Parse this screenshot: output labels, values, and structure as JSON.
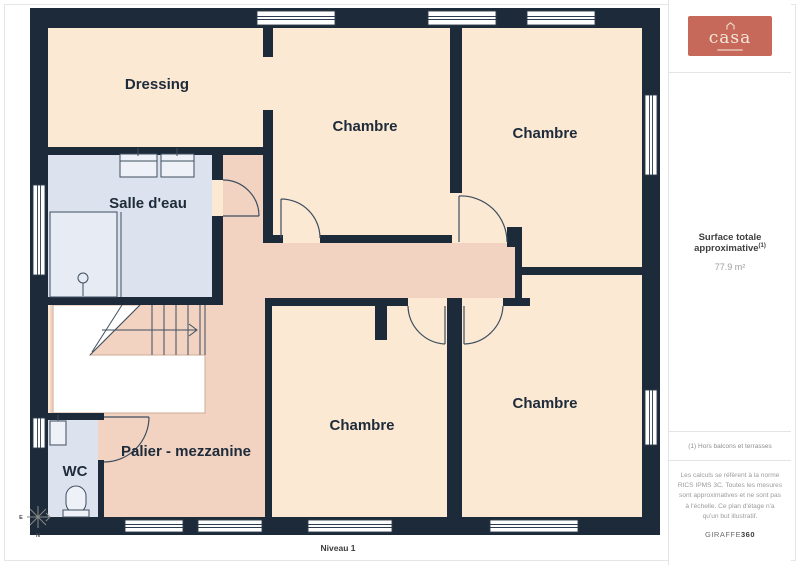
{
  "plan": {
    "rooms": [
      {
        "name": "dressing",
        "label": "Dressing"
      },
      {
        "name": "chambre-top-middle",
        "label": "Chambre"
      },
      {
        "name": "chambre-top-right",
        "label": "Chambre"
      },
      {
        "name": "salle-deau",
        "label": "Salle d'eau"
      },
      {
        "name": "chambre-bottom-right",
        "label": "Chambre"
      },
      {
        "name": "chambre-bottom-middle",
        "label": "Chambre"
      },
      {
        "name": "palier",
        "label": "Palier - mezzanine"
      },
      {
        "name": "wc",
        "label": "WC"
      }
    ],
    "level_label": "Niveau 1",
    "compass": {
      "east": "E",
      "north": "N"
    },
    "colors": {
      "wall": "#1d2a39",
      "room_fill": "#fbe9d3",
      "hall_fill": "#f2d3c1",
      "wet_room_fill": "#dde3ee",
      "fixture_fill": "#eef1f7",
      "logo_bg": "#c7695a"
    }
  },
  "sidebar": {
    "logo": {
      "brand": "casa"
    },
    "surface": {
      "title": "Surface totale approximative",
      "note_ref": "(1)",
      "value": "77.9 m²"
    },
    "footnote": "(1) Hors balcons et terrasses",
    "disclaimer": "Les calculs se réfèrent à la norme RICS IPMS 3C. Toutes les mesures sont approximatives et ne sont pas à l'échelle. Ce plan d'étage n'a qu'un but illustratif.",
    "watermark": {
      "brand": "GIRAFFE",
      "suffix": "360"
    }
  }
}
